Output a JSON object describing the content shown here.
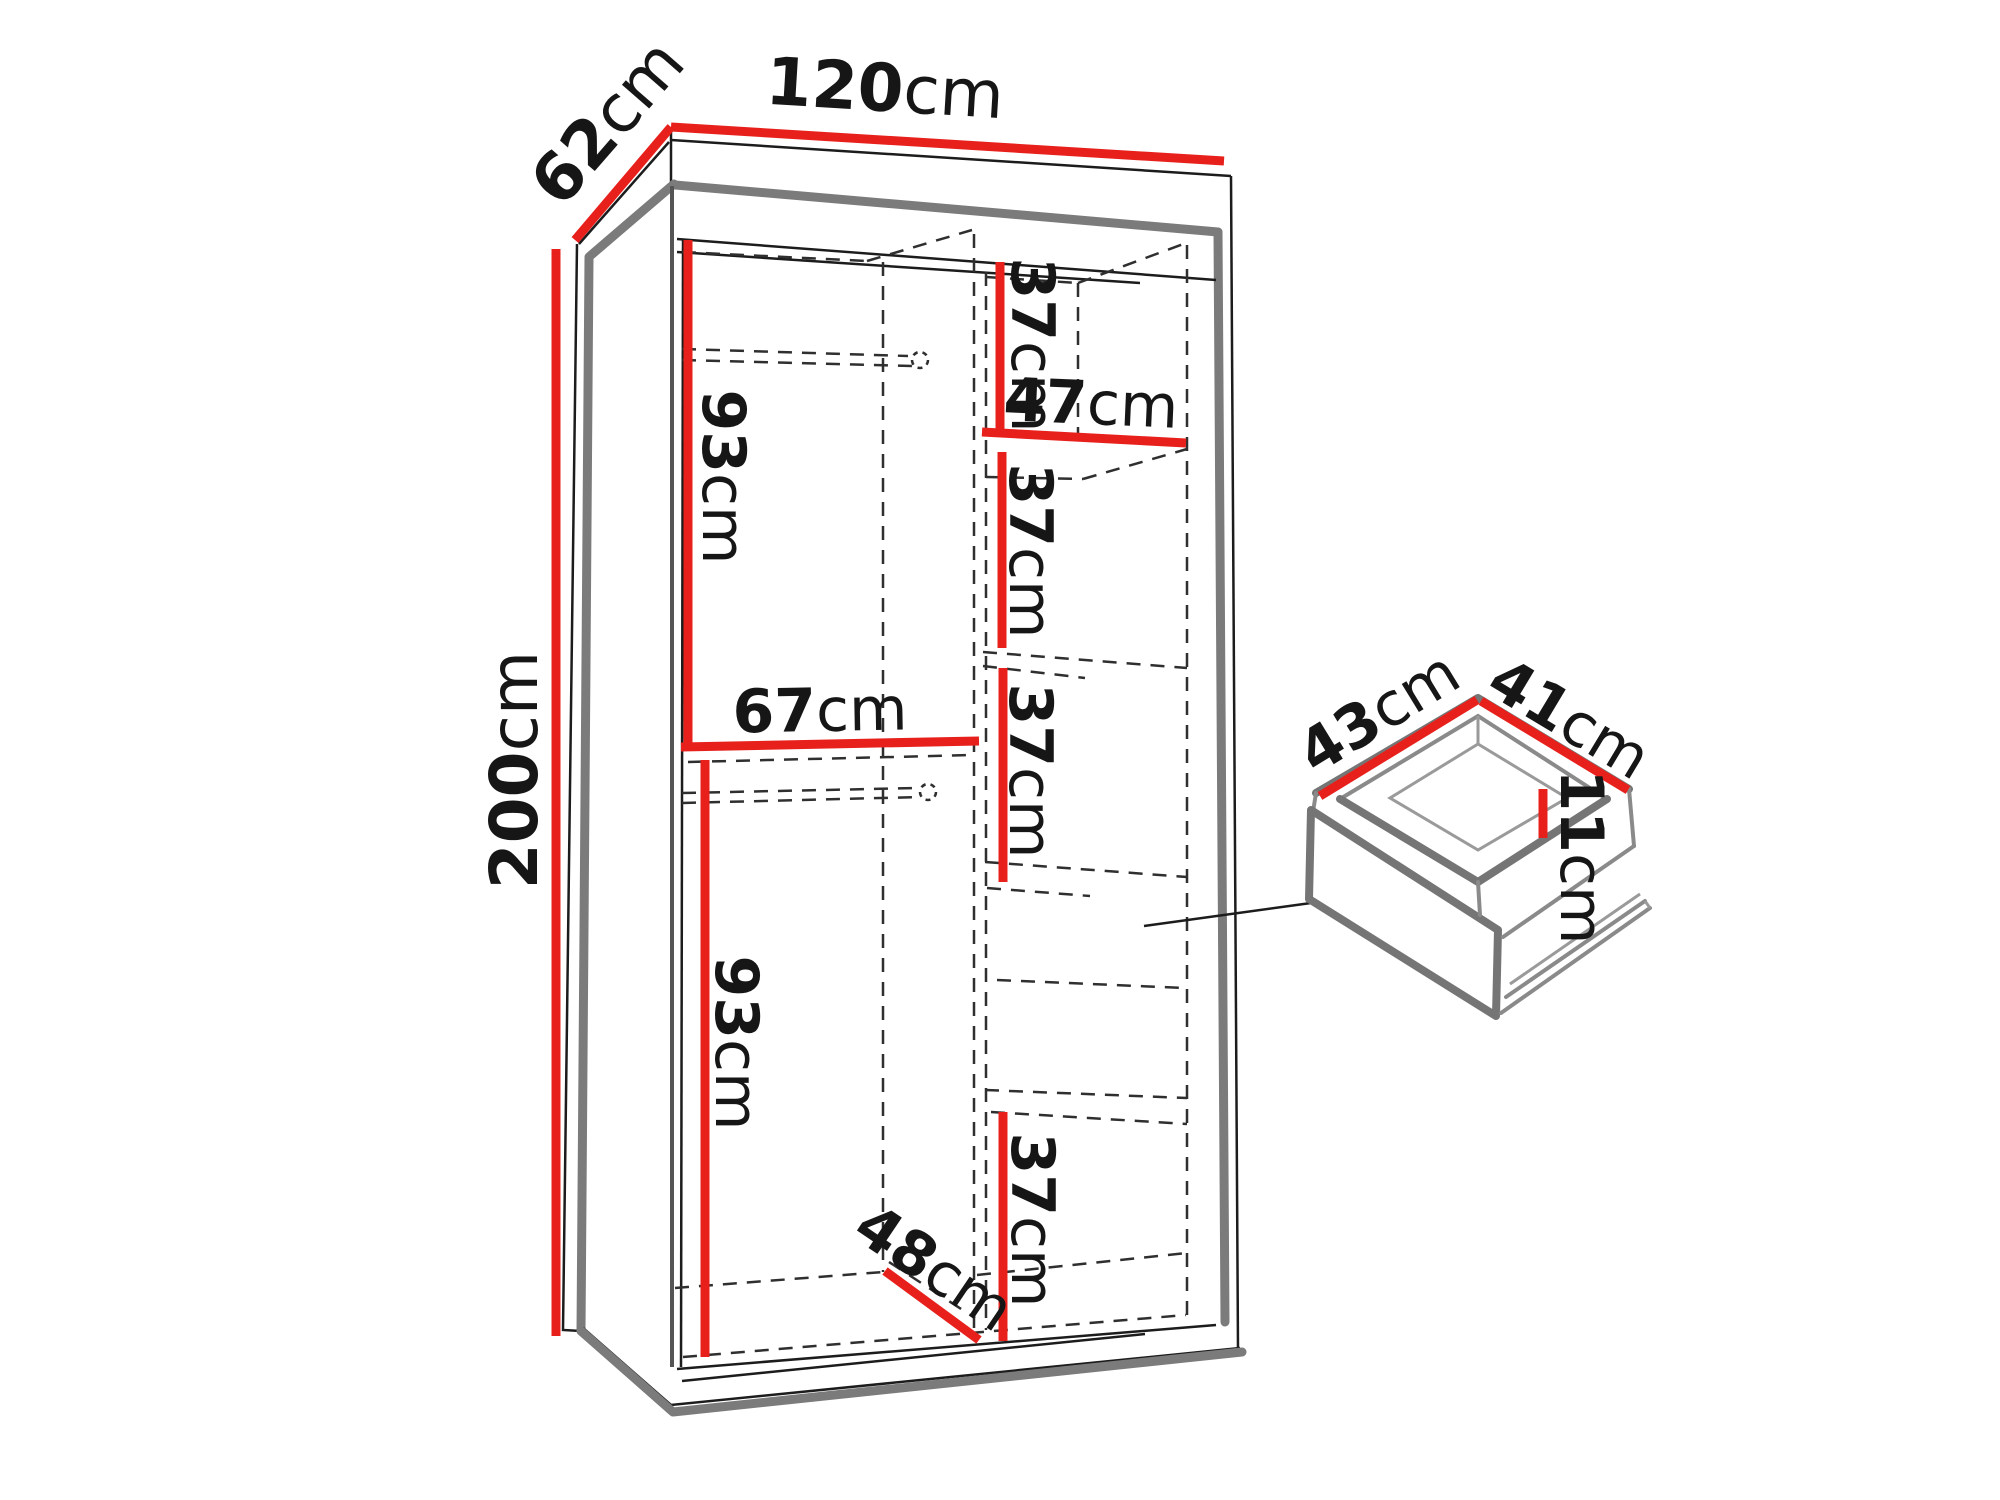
{
  "title": "Wardrobe dimensions diagram",
  "unit": "cm",
  "colors": {
    "dimension_line": "#e8201c",
    "outline_shadow": "#7b7b7b",
    "edge_line": "#1c1c1c",
    "hidden_edge": "#2f2f2f",
    "background": "#ffffff"
  },
  "wardrobe": {
    "width": "120",
    "depth": "62",
    "height": "200",
    "upper_left_section_height": "93",
    "lower_left_section_height": "93",
    "left_shelf_width": "67",
    "right_shelf_width": "47",
    "right_section_heights": [
      "37",
      "37",
      "37",
      "37"
    ],
    "bottom_inner_depth": "48"
  },
  "drawer": {
    "depth": "43",
    "width": "41",
    "front_height": "11"
  }
}
